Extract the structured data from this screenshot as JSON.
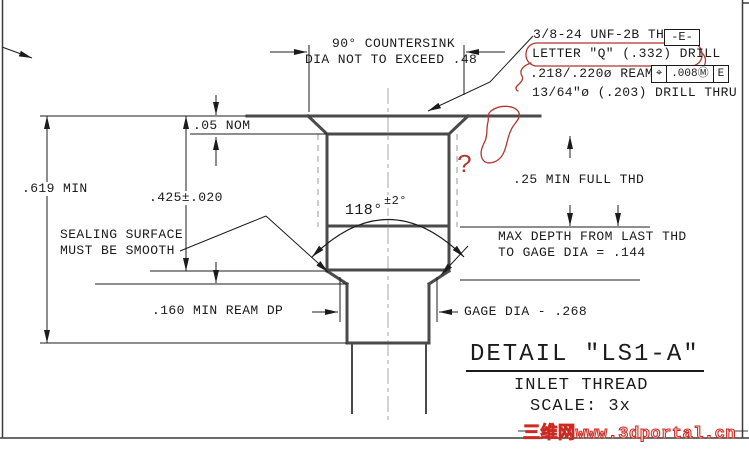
{
  "drawing": {
    "countersink_note": {
      "line1": "90° COUNTERSINK",
      "line2": "DIA NOT TO EXCEED .48"
    },
    "thread_notes": {
      "thread": "3/8-24 UNF-2B THD",
      "datum_flag": "-E-",
      "drill_q": "LETTER \"Q\" (.332) DRILL",
      "ream": ".218/.220ø REAM",
      "fcf": {
        "position_symbol": "⌖",
        "tolerance": ".008Ⓜ",
        "datum": "E"
      },
      "drill_thru": "13/64\"ø (.203) DRILL THRU"
    },
    "dimensions": {
      "nom_05": ".05 NOM",
      "min_619": ".619 MIN",
      "tol_425": ".425±.020",
      "angle": "118°",
      "angle_tol": "±2°",
      "full_thd": ".25 MIN FULL THD",
      "max_depth_line1": "MAX DEPTH FROM LAST THD",
      "max_depth_line2": "TO GAGE DIA = .144",
      "ream_dp": ".160 MIN REAM DP",
      "gage_dia": "GAGE DIA - .268"
    },
    "notes": {
      "sealing_line1": "SEALING SURFACE",
      "sealing_line2": "MUST BE SMOOTH"
    },
    "title_block": {
      "title": "DETAIL \"LS1-A\"",
      "subtitle": "INLET THREAD",
      "scale": "SCALE: 3x"
    },
    "annotations": {
      "question_mark": "?",
      "watermark": "三维网www.3dportal.cn"
    },
    "colors": {
      "line_thick": "#4a4a4a",
      "line_thin": "#1c1c1c",
      "redline": "#b5342e",
      "watermark_red": "#cc2a22"
    }
  }
}
